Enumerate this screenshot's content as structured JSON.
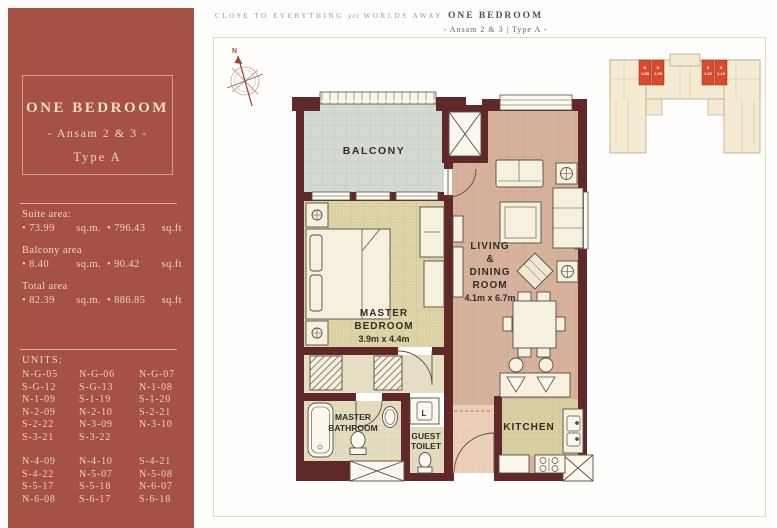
{
  "page": {
    "tagline_pre": "CLOSE TO EVERYTHING",
    "tagline_italic": "yet",
    "tagline_post": "WORLDS AWAY",
    "header_title": "ONE BEDROOM",
    "header_subtitle": "- Ansam 2 & 3  |  Type A -"
  },
  "sidebar": {
    "title": "ONE BEDROOM",
    "subtitle": "- Ansam 2 & 3 -",
    "type_label": "Type A",
    "areas": [
      {
        "label": "Suite area:",
        "m_val": "• 73.99",
        "m_unit": "sq.m.",
        "i_val": "• 796.43",
        "i_unit": "sq.ft"
      },
      {
        "label": "Balcony area",
        "m_val": "• 8.40",
        "m_unit": "sq.m.",
        "i_val": "• 90.42",
        "i_unit": "sq.ft"
      },
      {
        "label": "Total area",
        "m_val": "• 82.39",
        "m_unit": "sq.m.",
        "i_val": "• 886.85",
        "i_unit": "sq.ft"
      }
    ],
    "units_label": "UNITS:",
    "units_group1": [
      "N-G-05",
      "N-G-06",
      "N-G-07",
      "S-G-12",
      "S-G-13",
      "N-1-08",
      "N-1-09",
      "S-1-19",
      "S-1-20",
      "N-2-09",
      "N-2-10",
      "S-2-21",
      "S-2-22",
      "N-3-09",
      "N-3-10",
      "S-3-21",
      "S-3-22"
    ],
    "units_group2": [
      "N-4-09",
      "N-4-10",
      "S-4-21",
      "S-4-22",
      "N-5-07",
      "N-5-08",
      "S-5-17",
      "S-5-18",
      "N-6-07",
      "N-6-08",
      "S-6-17",
      "S-6-18"
    ]
  },
  "plan": {
    "labels": {
      "compass_n": "N",
      "balcony": "BALCONY",
      "bedroom_l1": "MASTER",
      "bedroom_l2": "BEDROOM",
      "bedroom_dims": "3.9m x 4.4m",
      "living_l1": "LIVING",
      "living_l2": "&",
      "living_l3": "DINING",
      "living_l4": "ROOM",
      "living_dims": "4.1m x 6.7m",
      "bath_l1": "MASTER",
      "bath_l2": "BATHROOM",
      "guest_l1": "GUEST",
      "guest_l2": "TOILET",
      "kitchen": "KITCHEN",
      "laundry": "L"
    }
  },
  "keyplan": {
    "units": [
      {
        "line1": "N",
        "line2": "1-08"
      },
      {
        "line1": "N",
        "line2": "1-09"
      },
      {
        "line1": "S",
        "line2": "1-20"
      },
      {
        "line1": "S",
        "line2": "1-19"
      }
    ]
  },
  "colors": {
    "sidebar_bg": "#A55244",
    "sidebar_text": "#EFD4B7",
    "wall": "#612829",
    "balcony_floor": "#D5D9D4",
    "bedroom_floor": "#DCD3A6",
    "living_floor": "#D6B19B",
    "kitchen_floor": "#DACFA3",
    "bath_floor": "#E4DCBF",
    "entry_floor": "#EBCFBA",
    "furniture": "#F6F0DE",
    "keyplan_highlight": "#DA4A2C",
    "header_text": "#46565F"
  }
}
